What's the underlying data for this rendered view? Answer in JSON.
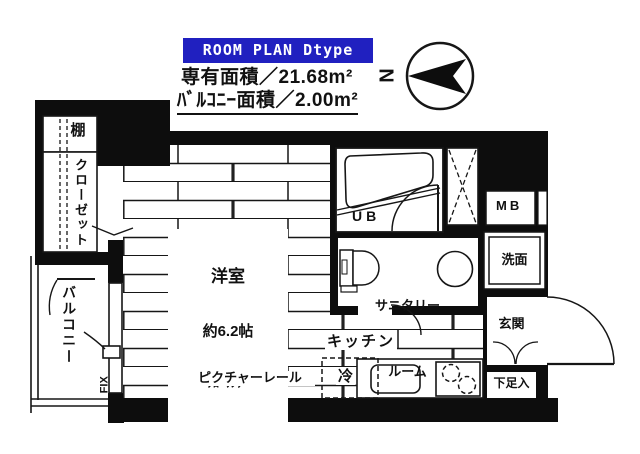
{
  "header": {
    "badge": "ROOM PLAN   Dtype",
    "area_line1": "専有面積／21.68m²",
    "area_line2": "ﾊﾞﾙｺﾆｰ面積／2.00m²"
  },
  "compass": {
    "north_label": "N"
  },
  "rooms": {
    "shelf": "棚",
    "closet": "クローゼット",
    "balcony": "バルコニー",
    "fix_window": "FIX",
    "room_name": "洋室",
    "room_size": "約6.2帖",
    "room_floor": "ﾌﾛｰﾘﾝｸﾞ",
    "unit_bath": "UB",
    "meter_box": "MB",
    "washbasin": "洗面",
    "sanitary_line1": "サニタリー",
    "sanitary_line2": "ルーム",
    "kitchen": "キッチン",
    "fridge": "冷",
    "entrance": "玄関",
    "shoe_box": "下足入",
    "picture_rail": "ピクチャーレール"
  },
  "colors": {
    "badge_bg": "#2020c0",
    "wall": "#0d0d0d",
    "line": "#161616"
  }
}
